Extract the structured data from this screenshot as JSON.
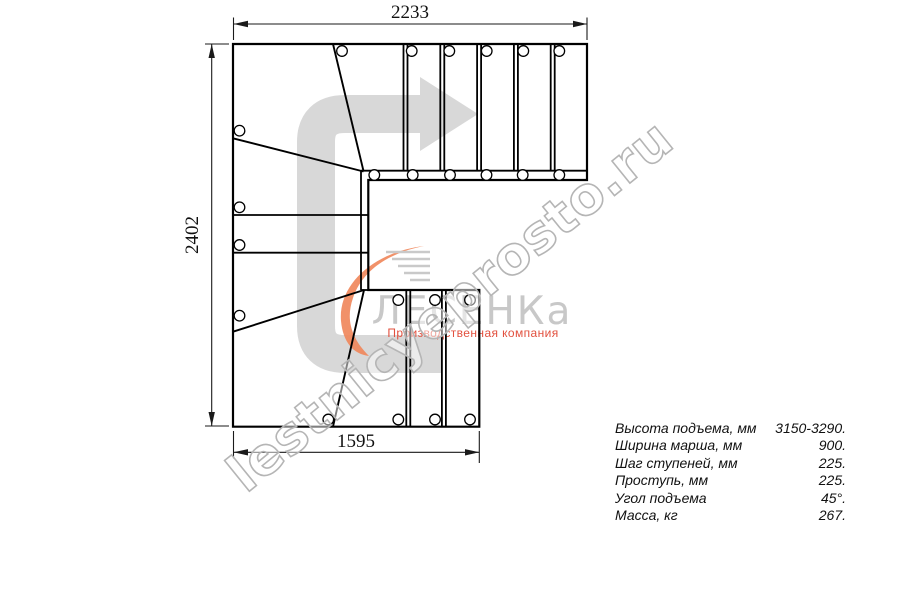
{
  "drawing": {
    "dim_top": "2233",
    "dim_left": "2402",
    "dim_bottom": "1595"
  },
  "watermark": {
    "text": "lestnicyeprosto.ru"
  },
  "logo": {
    "name": "ЛЕСЕНКа",
    "tagline": "Производственная компания"
  },
  "specs": {
    "rows": [
      {
        "label": "Высота подъема, мм",
        "value": "3150-3290."
      },
      {
        "label": "Ширина марша, мм",
        "value": "900."
      },
      {
        "label": "Шаг ступеней, мм",
        "value": "225."
      },
      {
        "label": "Проступь, мм",
        "value": "225."
      },
      {
        "label": "Угол подъема",
        "value": "45°."
      },
      {
        "label": "Масса, кг",
        "value": "267."
      }
    ]
  },
  "colors": {
    "line": "#000000",
    "arrow": "#d8d8d8",
    "swoosh": "#f0885c",
    "logo_text": "#c8c8c8",
    "tagline": "#e2503e",
    "watermark_stroke": "#b5b5b5"
  }
}
